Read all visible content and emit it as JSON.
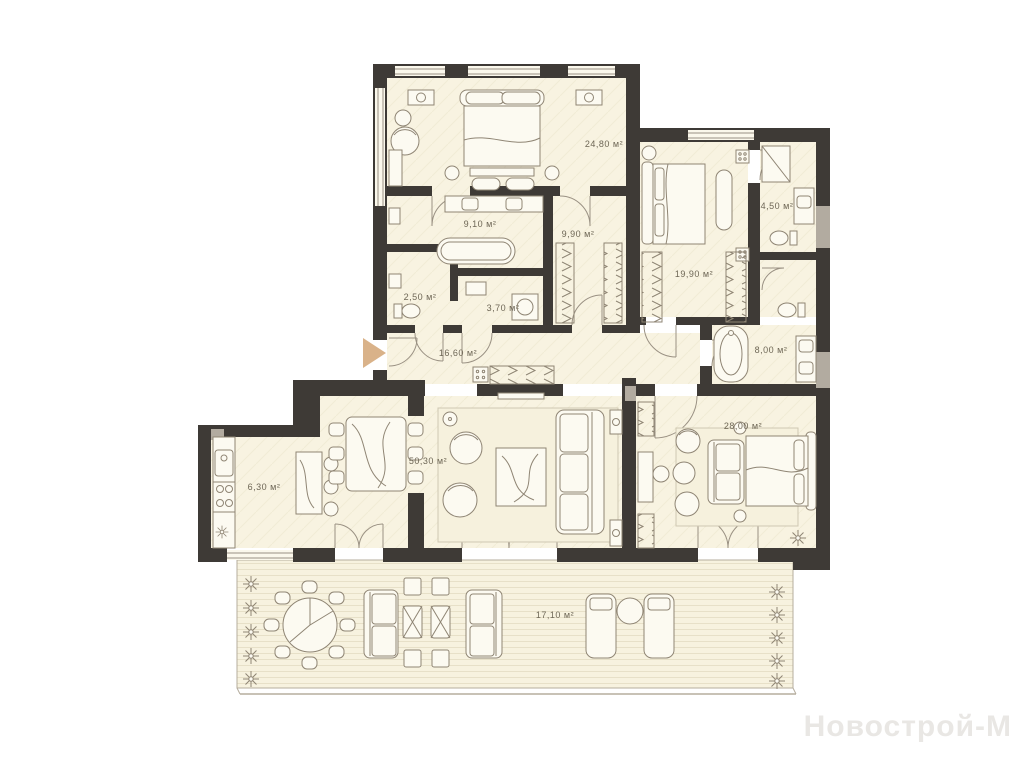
{
  "plan": {
    "type": "apartment-floor-plan",
    "watermark": "Новострой-М",
    "colors": {
      "wall": "#3e3a36",
      "floor": "#f8f3e1",
      "deck_line": "#e7e0c8",
      "furniture_line": "#8f8574",
      "entrance_arrow": "#d9b289",
      "label_text": "#6e6756",
      "watermark_text": "#e9e7e4"
    },
    "rooms": [
      {
        "id": "bedroom-master",
        "area_label": "24,80 м²"
      },
      {
        "id": "bathroom-master",
        "area_label": "9,10 м²"
      },
      {
        "id": "wardrobe",
        "area_label": "9,90 м²"
      },
      {
        "id": "wc",
        "area_label": "2,50 м²"
      },
      {
        "id": "laundry",
        "area_label": "3,70 м²"
      },
      {
        "id": "bedroom-second",
        "area_label": "19,90 м²"
      },
      {
        "id": "bathroom-second",
        "area_label": "4,50 м²"
      },
      {
        "id": "bathroom-third",
        "area_label": "8,00 м²"
      },
      {
        "id": "hallway",
        "area_label": "16,60 м²"
      },
      {
        "id": "living-dining",
        "area_label": "50,30 м²"
      },
      {
        "id": "kitchen",
        "area_label": "6,30 м²"
      },
      {
        "id": "bedroom-third",
        "area_label": "28,00 м²"
      },
      {
        "id": "terrace",
        "area_label": "17,10 м²"
      }
    ]
  }
}
